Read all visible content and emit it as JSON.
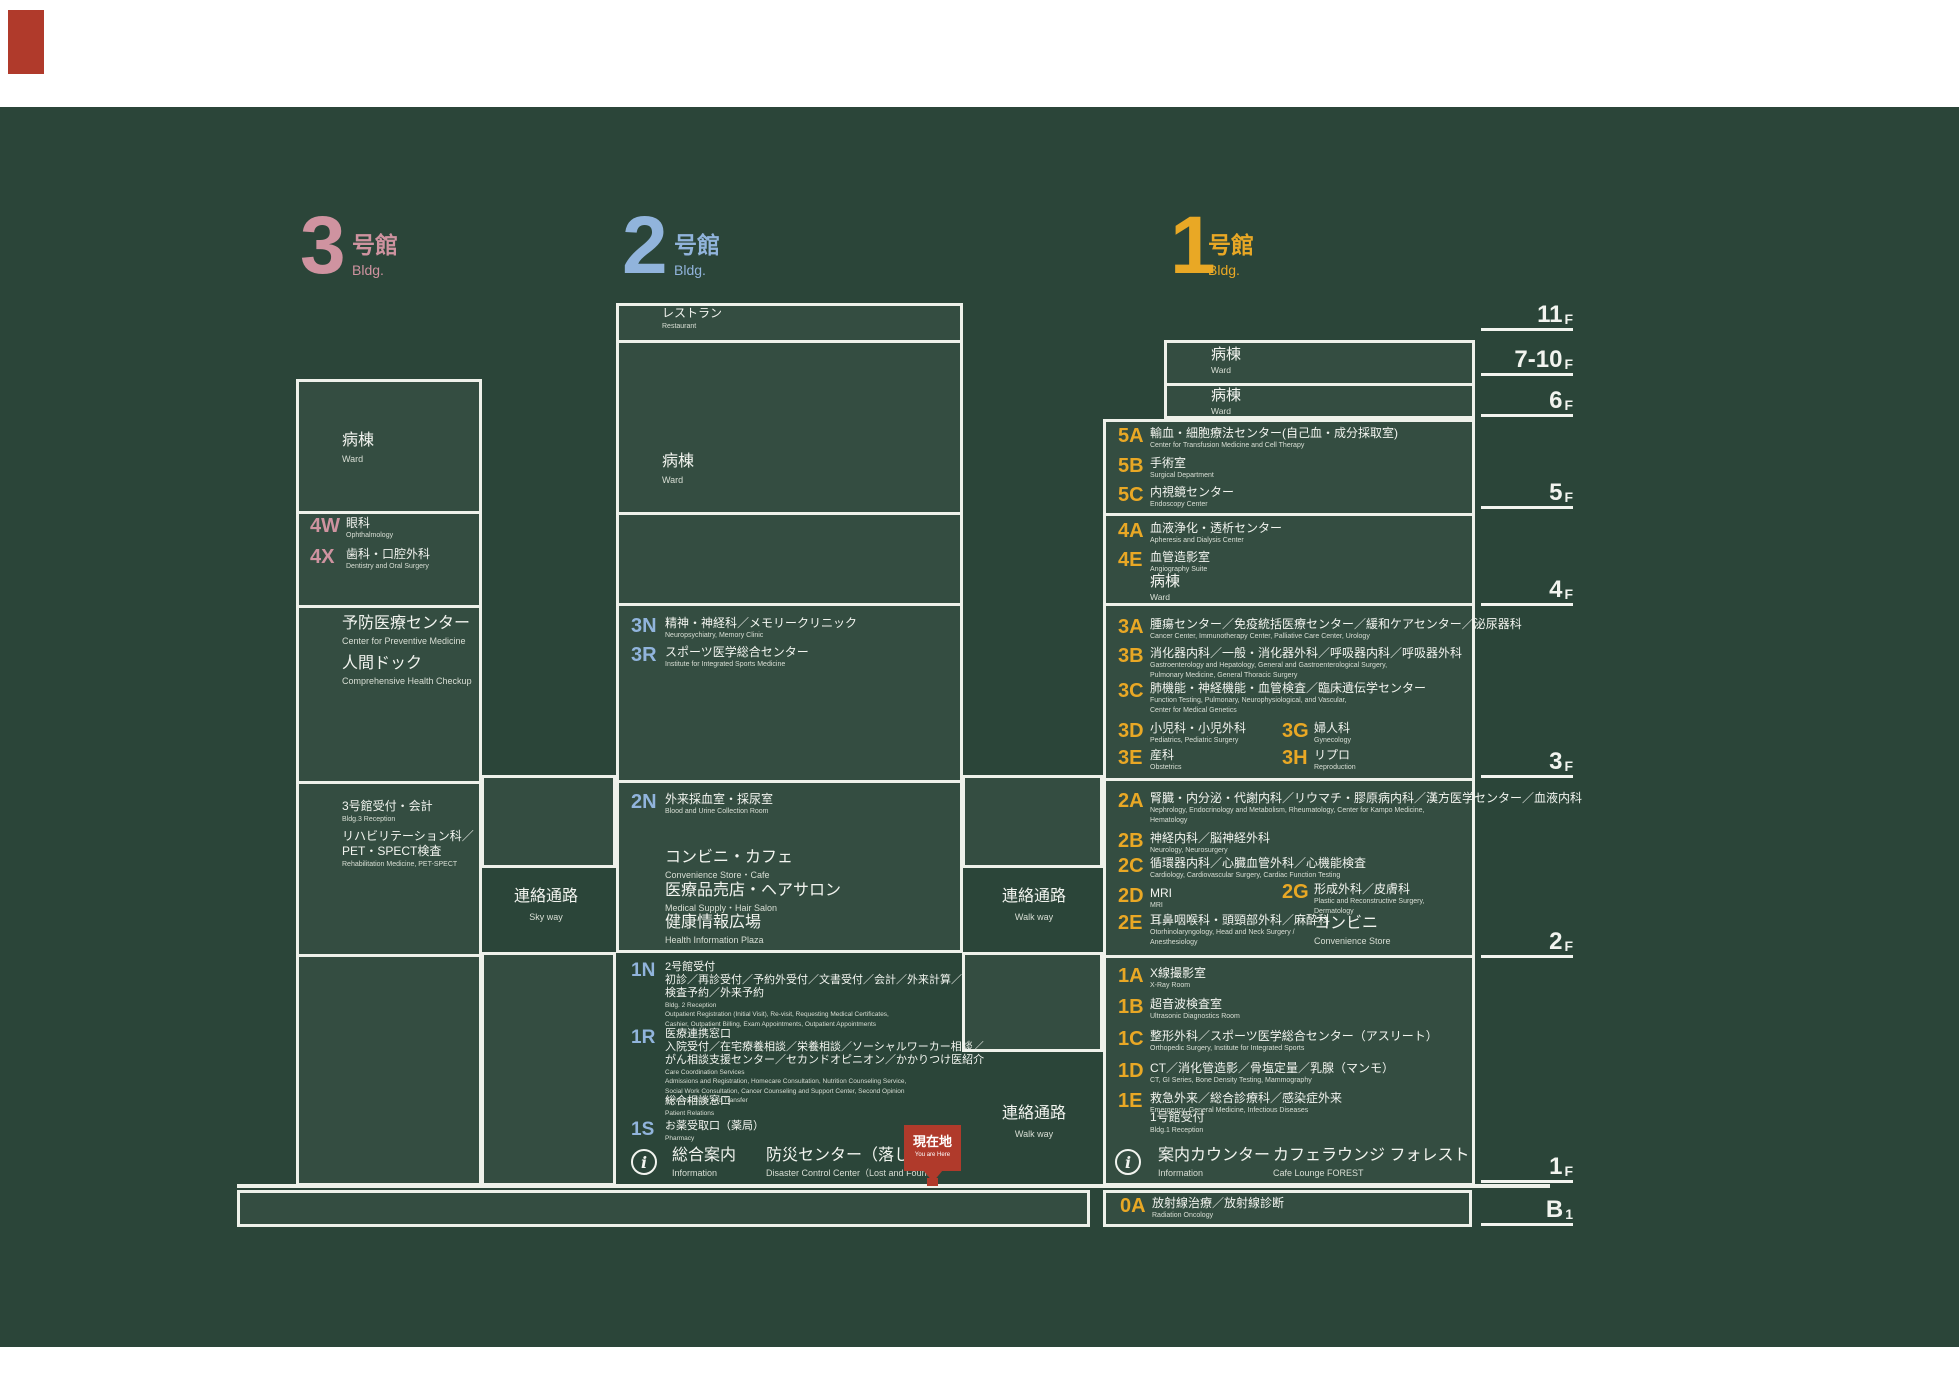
{
  "palette": {
    "bg": "#2b4539",
    "line": "#eef1ea",
    "pink": "#cf93a0",
    "blue": "#91b4dc",
    "yellow": "#e9a825",
    "red": "#b03a2b",
    "text": "#f2f4ef"
  },
  "marker": {
    "jp": "現在地",
    "en": "You are Here"
  },
  "info_icon_glyph": "i",
  "buildings": [
    {
      "id": "bldg3",
      "digit": "3",
      "title": "号館",
      "sub": "Bldg.",
      "color": "#cf93a0",
      "x": 300,
      "y": 205,
      "toff": 52
    },
    {
      "id": "bldg2",
      "digit": "2",
      "title": "号館",
      "sub": "Bldg.",
      "color": "#91b4dc",
      "x": 622,
      "y": 205,
      "toff": 52
    },
    {
      "id": "bldg1",
      "digit": "1",
      "title": "号館",
      "sub": "Bldg.",
      "color": "#e9a825",
      "x": 1170,
      "y": 205,
      "toff": 38
    }
  ],
  "floor_labels": [
    {
      "num": "11",
      "f": "F",
      "y": 296
    },
    {
      "num": "7-10",
      "f": "F",
      "y": 341
    },
    {
      "num": "6",
      "f": "F",
      "y": 382
    },
    {
      "num": "5",
      "f": "F",
      "y": 474
    },
    {
      "num": "4",
      "f": "F",
      "y": 571
    },
    {
      "num": "3",
      "f": "F",
      "y": 743
    },
    {
      "num": "2",
      "f": "F",
      "y": 923
    },
    {
      "num": "1",
      "f": "F",
      "y": 1148
    },
    {
      "num": "B",
      "f": "1",
      "y": 1191
    }
  ],
  "boxes": [
    {
      "id": "bldg3-box",
      "x": 296,
      "y": 379,
      "w": 186,
      "h": 807,
      "dividers": [
        130,
        224,
        400,
        573
      ]
    },
    {
      "id": "skyway-bridge",
      "x": 481,
      "y": 775,
      "w": 135,
      "h": 93,
      "dividers": []
    },
    {
      "id": "gap-left-1f",
      "x": 481,
      "y": 952,
      "w": 135,
      "h": 234,
      "dividers": []
    },
    {
      "id": "bldg2-box",
      "x": 616,
      "y": 303,
      "w": 347,
      "h": 650,
      "dividers": [
        35,
        207,
        298,
        475
      ]
    },
    {
      "id": "walkway-bridge",
      "x": 962,
      "y": 775,
      "w": 141,
      "h": 93,
      "dividers": []
    },
    {
      "id": "gap-right-1f",
      "x": 962,
      "y": 952,
      "w": 141,
      "h": 100,
      "dividers": []
    },
    {
      "id": "bldg1-ward-box",
      "x": 1164,
      "y": 340,
      "w": 311,
      "h": 79,
      "dividers": [
        41
      ]
    },
    {
      "id": "bldg1-box",
      "x": 1103,
      "y": 419,
      "w": 372,
      "h": 767,
      "dividers": [
        92,
        182,
        357,
        534
      ]
    },
    {
      "id": "b1-left-box",
      "x": 237,
      "y": 1190,
      "w": 853,
      "h": 37,
      "dividers": []
    },
    {
      "id": "b1-right-box",
      "x": 1103,
      "y": 1190,
      "w": 369,
      "h": 37,
      "dividers": []
    }
  ],
  "text_blocks": [
    {
      "id": "ward-bldg3",
      "x": 342,
      "y": 431,
      "sz": "L",
      "jp": [
        "病棟"
      ],
      "en": [
        "Ward"
      ]
    },
    {
      "id": "preventive-center",
      "x": 342,
      "y": 615,
      "sz": "M",
      "jp": [
        "予防医療センター"
      ],
      "en": [
        "Center for Preventive Medicine"
      ]
    },
    {
      "id": "health-checkup",
      "x": 342,
      "y": 655,
      "sz": "M",
      "jp": [
        "人間ドック"
      ],
      "en": [
        "Comprehensive Health Checkup"
      ]
    },
    {
      "id": "bldg3-reception",
      "x": 342,
      "y": 799,
      "sz": "S",
      "jp": [
        "3号館受付・会計"
      ],
      "en": [
        "Bldg.3 Reception"
      ]
    },
    {
      "id": "rehabilitation",
      "x": 342,
      "y": 829,
      "sz": "S",
      "jp": [
        "リハビリテーション科／",
        "PET・SPECT検査"
      ],
      "en": [
        "Rehabilitation Medicine, PET-SPECT"
      ]
    },
    {
      "id": "restaurant",
      "x": 662,
      "y": 306,
      "sz": "S",
      "jp": [
        "レストラン"
      ],
      "en": [
        "Restaurant"
      ]
    },
    {
      "id": "ward-bldg2",
      "x": 662,
      "y": 452,
      "sz": "L",
      "jp": [
        "病棟"
      ],
      "en": [
        "Ward"
      ]
    },
    {
      "id": "convenience-cafe",
      "x": 665,
      "y": 849,
      "sz": "M",
      "jp": [
        "コンビニ・カフェ"
      ],
      "en": [
        "Convenience Store・Cafe"
      ]
    },
    {
      "id": "medical-supply",
      "x": 665,
      "y": 882,
      "sz": "M",
      "jp": [
        "医療品売店・ヘアサロン"
      ],
      "en": [
        "Medical Supply・Hair Salon"
      ]
    },
    {
      "id": "health-plaza",
      "x": 665,
      "y": 914,
      "sz": "M",
      "jp": [
        "健康情報広場"
      ],
      "en": [
        "Health Information Plaza"
      ]
    },
    {
      "id": "ward-7-10f",
      "x": 1211,
      "y": 346,
      "sz": "W",
      "jp": [
        "病棟"
      ],
      "en": [
        "Ward"
      ]
    },
    {
      "id": "ward-6f",
      "x": 1211,
      "y": 387,
      "sz": "W",
      "jp": [
        "病棟"
      ],
      "en": [
        "Ward"
      ]
    },
    {
      "id": "ward-4f",
      "x": 1150,
      "y": 573,
      "sz": "W",
      "jp": [
        "病棟"
      ],
      "en": [
        "Ward"
      ]
    },
    {
      "id": "convenience-2f",
      "x": 1314,
      "y": 915,
      "sz": "M",
      "jp": [
        "コンビニ"
      ],
      "en": [
        "Convenience Store"
      ]
    },
    {
      "id": "bldg1-reception",
      "x": 1150,
      "y": 1110,
      "sz": "S",
      "jp": [
        "1号館受付"
      ],
      "en": [
        "Bldg.1 Reception"
      ]
    },
    {
      "id": "general-info",
      "x": 672,
      "y": 1147,
      "sz": "M",
      "jp": [
        "総合案内"
      ],
      "en": [
        "Information"
      ]
    },
    {
      "id": "disaster-center",
      "x": 766,
      "y": 1147,
      "sz": "M",
      "jp": [
        "防災センター（落し物）"
      ],
      "en": [
        "Disaster Control Center（Lost and Found）"
      ]
    },
    {
      "id": "info-counter",
      "x": 1158,
      "y": 1147,
      "sz": "M",
      "jp": [
        "案内カウンター"
      ],
      "en": [
        "Information"
      ]
    },
    {
      "id": "cafe-lounge",
      "x": 1273,
      "y": 1147,
      "sz": "M",
      "jp": [
        "カフェラウンジ フォレスト"
      ],
      "en": [
        "Cafe Lounge FOREST"
      ]
    }
  ],
  "entries": [
    {
      "code": "4W",
      "c": "pink",
      "x": 310,
      "y": 516,
      "off": 36,
      "jp": [
        "眼科"
      ],
      "en": [
        "Ophthalmology"
      ]
    },
    {
      "code": "4X",
      "c": "pink",
      "x": 310,
      "y": 547,
      "off": 36,
      "jp": [
        "歯科・口腔外科"
      ],
      "en": [
        "Dentistry and Oral Surgery"
      ]
    },
    {
      "code": "3N",
      "c": "blue",
      "x": 631,
      "y": 616,
      "off": 34,
      "jp": [
        "精神・神経科／メモリークリニック"
      ],
      "en": [
        "Neuropsychiatry, Memory Clinic"
      ]
    },
    {
      "code": "3R",
      "c": "blue",
      "x": 631,
      "y": 645,
      "off": 34,
      "jp": [
        "スポーツ医学総合センター"
      ],
      "en": [
        "Institute for Integrated Sports Medicine"
      ]
    },
    {
      "code": "2N",
      "c": "blue",
      "x": 631,
      "y": 792,
      "off": 34,
      "jp": [
        "外来採血室・採尿室"
      ],
      "en": [
        "Blood and Urine Collection Room"
      ]
    },
    {
      "code": "1N",
      "c": "blue",
      "x": 631,
      "y": 961,
      "off": 34,
      "small": true,
      "jp": [
        "2号館受付",
        "初診／再診受付／予約外受付／文書受付／会計／外来計算／",
        "検査予約／外来予約"
      ],
      "en": [
        "Bldg. 2 Reception",
        "Outpatient Registration (Initial Visit), Re-visit, Requesting Medical Certificates,",
        "Cashier, Outpatient Billing, Exam Appointments, Outpatient Appointments"
      ]
    },
    {
      "code": "1R",
      "c": "blue",
      "x": 631,
      "y": 1028,
      "off": 34,
      "small": true,
      "jp": [
        "医療連携窓口",
        "入院受付／在宅療養相談／栄養相談／ソーシャルワーカー相談／",
        "がん相談支援センター／セカンドオピニオン／かかりつけ医紹介"
      ],
      "en": [
        "Care Coordination Services",
        "Admissions and Registration, Homecare Consultation, Nutrition Counseling Service,",
        "Social Work Consultation, Cancer Counseling and Support Center, Second Opinion",
        "Services, Refer and Transfer"
      ]
    },
    {
      "code": "",
      "c": "blue",
      "x": 665,
      "y": 1095,
      "off": 0,
      "small": true,
      "jp": [
        "総合相談窓口"
      ],
      "en": [
        "Patient Relations"
      ]
    },
    {
      "code": "1S",
      "c": "blue",
      "x": 631,
      "y": 1120,
      "off": 34,
      "small": true,
      "jp": [
        "お薬受取口（薬局）"
      ],
      "en": [
        "Pharmacy"
      ]
    },
    {
      "code": "5A",
      "c": "yellow",
      "x": 1118,
      "y": 426,
      "off": 32,
      "jp": [
        "輸血・細胞療法センター(自己血・成分採取室)"
      ],
      "en": [
        "Center for Transfusion Medicine and Cell Therapy"
      ]
    },
    {
      "code": "5B",
      "c": "yellow",
      "x": 1118,
      "y": 456,
      "off": 32,
      "jp": [
        "手術室"
      ],
      "en": [
        "Surgical Department"
      ]
    },
    {
      "code": "5C",
      "c": "yellow",
      "x": 1118,
      "y": 485,
      "off": 32,
      "jp": [
        "内視鏡センター"
      ],
      "en": [
        "Endoscopy Center"
      ]
    },
    {
      "code": "4A",
      "c": "yellow",
      "x": 1118,
      "y": 521,
      "off": 32,
      "jp": [
        "血液浄化・透析センター"
      ],
      "en": [
        "Apheresis and Dialysis Center"
      ]
    },
    {
      "code": "4E",
      "c": "yellow",
      "x": 1118,
      "y": 550,
      "off": 32,
      "jp": [
        "血管造影室"
      ],
      "en": [
        "Angiography Suite"
      ]
    },
    {
      "code": "3A",
      "c": "yellow",
      "x": 1118,
      "y": 617,
      "off": 32,
      "jp": [
        "腫瘍センター／免疫統括医療センター／緩和ケアセンター／泌尿器科"
      ],
      "en": [
        "Cancer Center, Immunotherapy Center, Palliative Care Center, Urology"
      ]
    },
    {
      "code": "3B",
      "c": "yellow",
      "x": 1118,
      "y": 646,
      "off": 32,
      "jp": [
        "消化器内科／一般・消化器外科／呼吸器内科／呼吸器外科"
      ],
      "en": [
        "Gastroenterology and Hepatology, General and Gastroenterological Surgery,",
        "Pulmonary Medicine, General Thoracic Surgery"
      ]
    },
    {
      "code": "3C",
      "c": "yellow",
      "x": 1118,
      "y": 681,
      "off": 32,
      "jp": [
        "肺機能・神経機能・血管検査／臨床遺伝学センター"
      ],
      "en": [
        "Function Testing, Pulmonary, Neurophysiological, and Vascular,",
        "Center for Medical Genetics"
      ]
    },
    {
      "code": "3D",
      "c": "yellow",
      "x": 1118,
      "y": 721,
      "off": 32,
      "jp": [
        "小児科・小児外科"
      ],
      "en": [
        "Pediatrics, Pediatric Surgery"
      ]
    },
    {
      "code": "3G",
      "c": "yellow",
      "x": 1282,
      "y": 721,
      "off": 32,
      "jp": [
        "婦人科"
      ],
      "en": [
        "Gynecology"
      ]
    },
    {
      "code": "3E",
      "c": "yellow",
      "x": 1118,
      "y": 748,
      "off": 32,
      "jp": [
        "産科"
      ],
      "en": [
        "Obstetrics"
      ]
    },
    {
      "code": "3H",
      "c": "yellow",
      "x": 1282,
      "y": 748,
      "off": 32,
      "jp": [
        "リプロ"
      ],
      "en": [
        "Reproduction"
      ]
    },
    {
      "code": "2A",
      "c": "yellow",
      "x": 1118,
      "y": 791,
      "off": 32,
      "jp": [
        "腎臓・内分泌・代謝内科／リウマチ・膠原病内科／漢方医学センター／血液内科"
      ],
      "en": [
        "Nephrology, Endocrinology and Metabolism, Rheumatology, Center for Kampo Medicine,",
        "Hematology"
      ]
    },
    {
      "code": "2B",
      "c": "yellow",
      "x": 1118,
      "y": 831,
      "off": 32,
      "jp": [
        "神経内科／脳神経外科"
      ],
      "en": [
        "Neurology, Neurosurgery"
      ]
    },
    {
      "code": "2C",
      "c": "yellow",
      "x": 1118,
      "y": 856,
      "off": 32,
      "jp": [
        "循環器内科／心臓血管外科／心機能検査"
      ],
      "en": [
        "Cardiology, Cardiovascular Surgery, Cardiac Function Testing"
      ]
    },
    {
      "code": "2D",
      "c": "yellow",
      "x": 1118,
      "y": 886,
      "off": 32,
      "jp": [
        "MRI"
      ],
      "en": [
        "MRI"
      ]
    },
    {
      "code": "2G",
      "c": "yellow",
      "x": 1282,
      "y": 882,
      "off": 32,
      "jp": [
        "形成外科／皮膚科"
      ],
      "en": [
        "Plastic and Reconstructive Surgery,",
        "Dermatology"
      ]
    },
    {
      "code": "2E",
      "c": "yellow",
      "x": 1118,
      "y": 913,
      "off": 32,
      "jp": [
        "耳鼻咽喉科・頭頸部外科／麻酔科"
      ],
      "en": [
        "Otorhinolaryngology, Head and Neck Surgery /",
        "Anesthesiology"
      ]
    },
    {
      "code": "1A",
      "c": "yellow",
      "x": 1118,
      "y": 966,
      "off": 32,
      "jp": [
        "X線撮影室"
      ],
      "en": [
        "X-Ray Room"
      ]
    },
    {
      "code": "1B",
      "c": "yellow",
      "x": 1118,
      "y": 997,
      "off": 32,
      "jp": [
        "超音波検査室"
      ],
      "en": [
        "Ultrasonic Diagnostics Room"
      ]
    },
    {
      "code": "1C",
      "c": "yellow",
      "x": 1118,
      "y": 1029,
      "off": 32,
      "jp": [
        "整形外科／スポーツ医学総合センター（アスリート）"
      ],
      "en": [
        "Orthopedic Surgery, Institute for Integrated Sports"
      ]
    },
    {
      "code": "1D",
      "c": "yellow",
      "x": 1118,
      "y": 1061,
      "off": 32,
      "jp": [
        "CT／消化管造影／骨塩定量／乳腺（マンモ）"
      ],
      "en": [
        "CT, GI Series, Bone Density Testing, Mammography"
      ]
    },
    {
      "code": "1E",
      "c": "yellow",
      "x": 1118,
      "y": 1091,
      "off": 32,
      "jp": [
        "救急外来／総合診療科／感染症外来"
      ],
      "en": [
        "Emergency, General Medicine, Infectious Diseases"
      ]
    },
    {
      "code": "0A",
      "c": "yellow",
      "x": 1120,
      "y": 1196,
      "off": 32,
      "jp": [
        "放射線治療／放射線診断"
      ],
      "en": [
        "Radiation Oncology"
      ]
    }
  ],
  "bridge_labels": [
    {
      "id": "skyway",
      "x": 546,
      "y": 888,
      "jp": "連絡通路",
      "en": "Sky way"
    },
    {
      "id": "walkway-2f",
      "x": 1034,
      "y": 888,
      "jp": "連絡通路",
      "en": "Walk way"
    },
    {
      "id": "walkway-1f",
      "x": 1034,
      "y": 1105,
      "jp": "連絡通路",
      "en": "Walk way"
    }
  ],
  "info_icons": [
    {
      "id": "info-icon-bldg2",
      "x": 631,
      "y": 1149
    },
    {
      "id": "info-icon-bldg1",
      "x": 1115,
      "y": 1149
    }
  ]
}
